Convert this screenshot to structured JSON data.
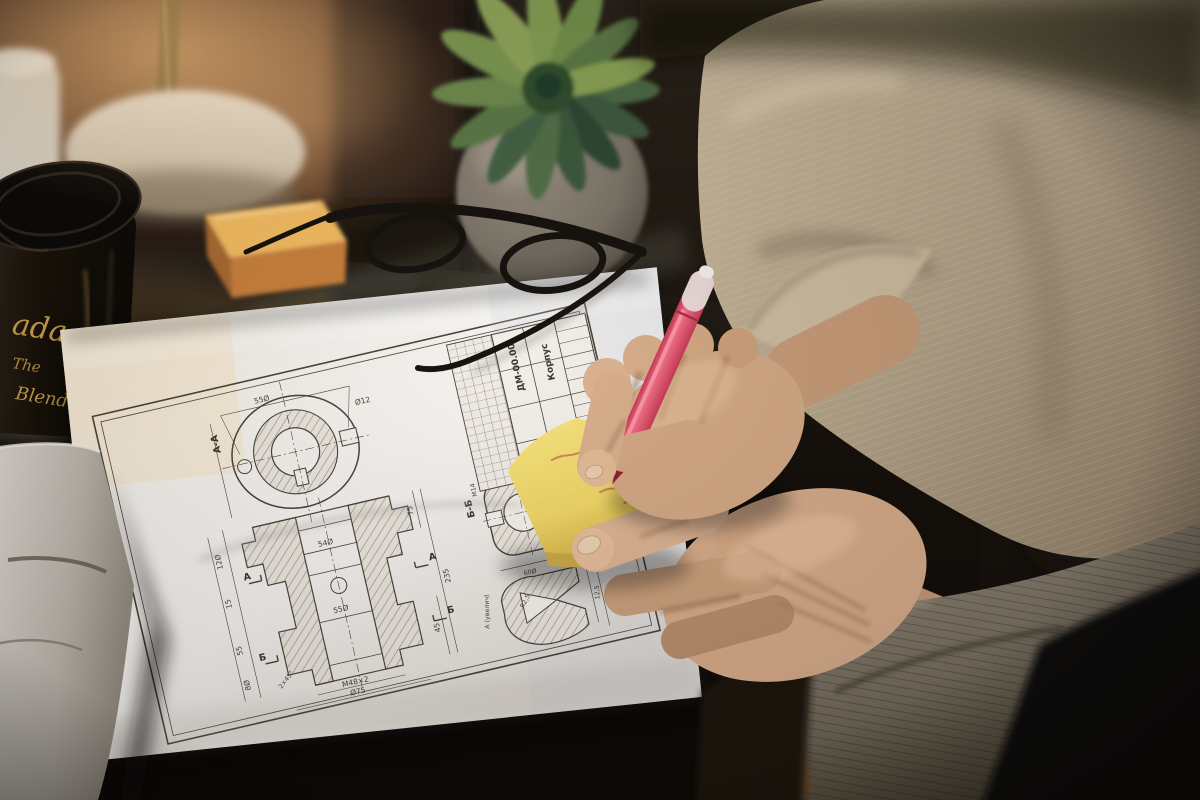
{
  "scene": {
    "description": "Person in beige jacket writing with a pink pen on a yellow sticky note above an engineering drawing on a dark glass desk"
  },
  "colors": {
    "paper": "#f4f1ec",
    "desk": "#17120d",
    "sticky_note_yellow": "#f2dc6e",
    "sticky_stack_orange": "#f0b95c",
    "pen_pink": "#ef5f7d",
    "jacket_beige": "#bfae93",
    "cuff_gray": "#847b6c",
    "skin": "#d3a986",
    "plant_green": "#5d7a47",
    "brick_wall": "#6b4631",
    "cup_gold_text": "#c9a04e",
    "drawing_ink": "#4d443a"
  },
  "coffee_cup": {
    "script_text": "ada",
    "line2": "The",
    "line3": "Blend"
  },
  "drawing": {
    "labels": {
      "section_aa": "А-А",
      "section_bb": "Б-Б",
      "detail": "А (увелич)",
      "arrow_a": "А",
      "arrow_b": "Б"
    },
    "title_block": {
      "doc_number": "ДМ-00.00",
      "part_name": "Корпус"
    },
    "dims": [
      "55Ø",
      "Ø12",
      "12Ø",
      "235",
      "75",
      "15",
      "55",
      "8Ø",
      "45",
      "2×45°",
      "55Ø",
      "М48×2",
      "Ø75",
      "М14",
      "60Ø",
      "1,6×45°",
      "R2,5",
      "12,5",
      "18,5",
      "54Ø"
    ]
  }
}
